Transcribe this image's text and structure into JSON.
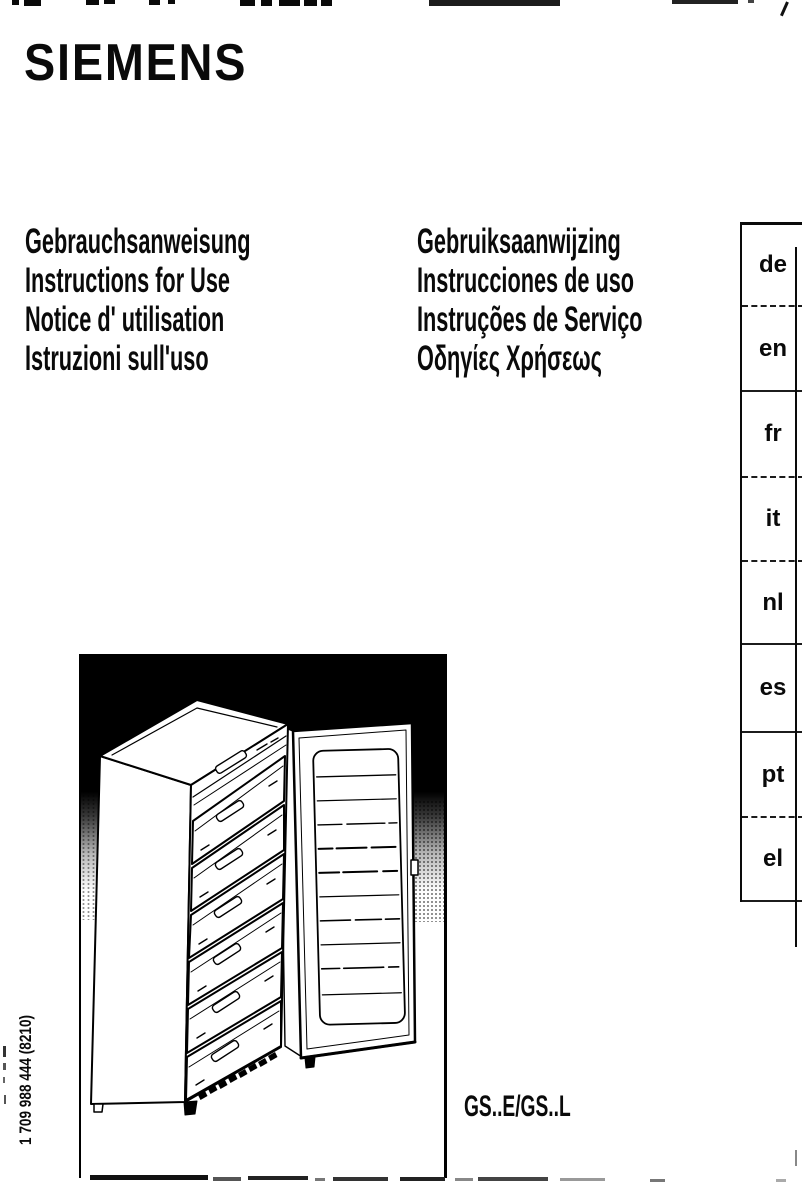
{
  "brand": {
    "logo": "SIEMENS"
  },
  "titles_left": [
    "Gebrauchsanweisung",
    "Instructions for Use",
    "Notice d' utilisation",
    "Istruzioni sull'uso"
  ],
  "titles_right": [
    "Gebruiksaanwijzing",
    "Instrucciones de uso",
    "Instruções de Serviço",
    "Οδηγίες Χρήσεως"
  ],
  "languages": [
    "de",
    "en",
    "fr",
    "it",
    "nl",
    "es",
    "pt",
    "el"
  ],
  "model": {
    "label": "GS..E/GS..L"
  },
  "part_number": "1 709 988 444 (8210)",
  "illustration": {
    "description": "upright freezer with six drawers and open door"
  },
  "colors": {
    "ink": "#0a0a0a",
    "background": "#ffffff"
  }
}
